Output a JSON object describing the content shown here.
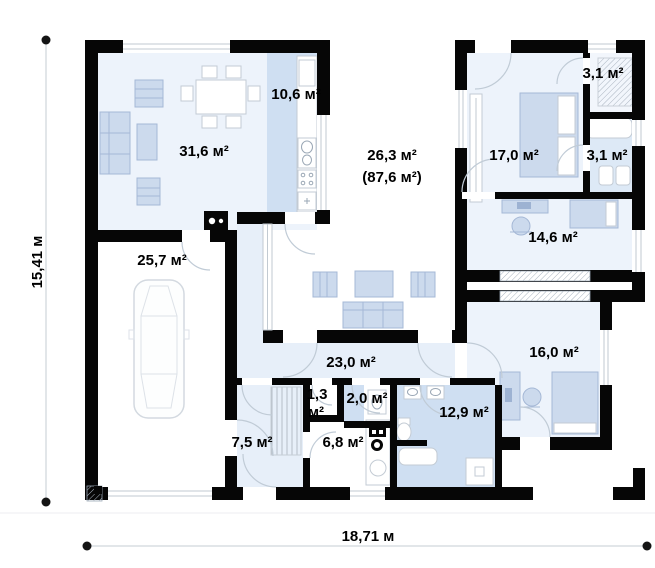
{
  "plan": {
    "type": "floor-plan",
    "rooms": {
      "living": {
        "label": "31,6 м²"
      },
      "kitchen": {
        "label": "10,6 м²"
      },
      "terrace": {
        "label": "26,3 м²",
        "label2": "(87,6 м²)"
      },
      "garage": {
        "label": "25,7 м²"
      },
      "bedroom1": {
        "label": "17,0 м²"
      },
      "wardrobe": {
        "label": "3,1 м²"
      },
      "bathroom_small": {
        "label": "3,1 м²"
      },
      "office": {
        "label": "14,6 м²"
      },
      "bedroom2": {
        "label": "16,0 м²"
      },
      "hall": {
        "label": "23,0 м²"
      },
      "entry": {
        "label": "7,5 м²"
      },
      "closet": {
        "label_line1": "1,3",
        "label_line2": "м²"
      },
      "wc": {
        "label": "2,0 м²"
      },
      "utility": {
        "label": "6,8 м²"
      },
      "bathroom_main": {
        "label": "12,9 м²"
      }
    },
    "dimensions": {
      "height_label": "15,41 м",
      "width_label": "18,71 м"
    },
    "colors": {
      "wall": "#060606",
      "room_light": "#edf3fb",
      "room_medium": "#cfdff2",
      "corridor": "#e7eff9",
      "furniture": "#ccdaed",
      "background": "#ffffff"
    }
  }
}
